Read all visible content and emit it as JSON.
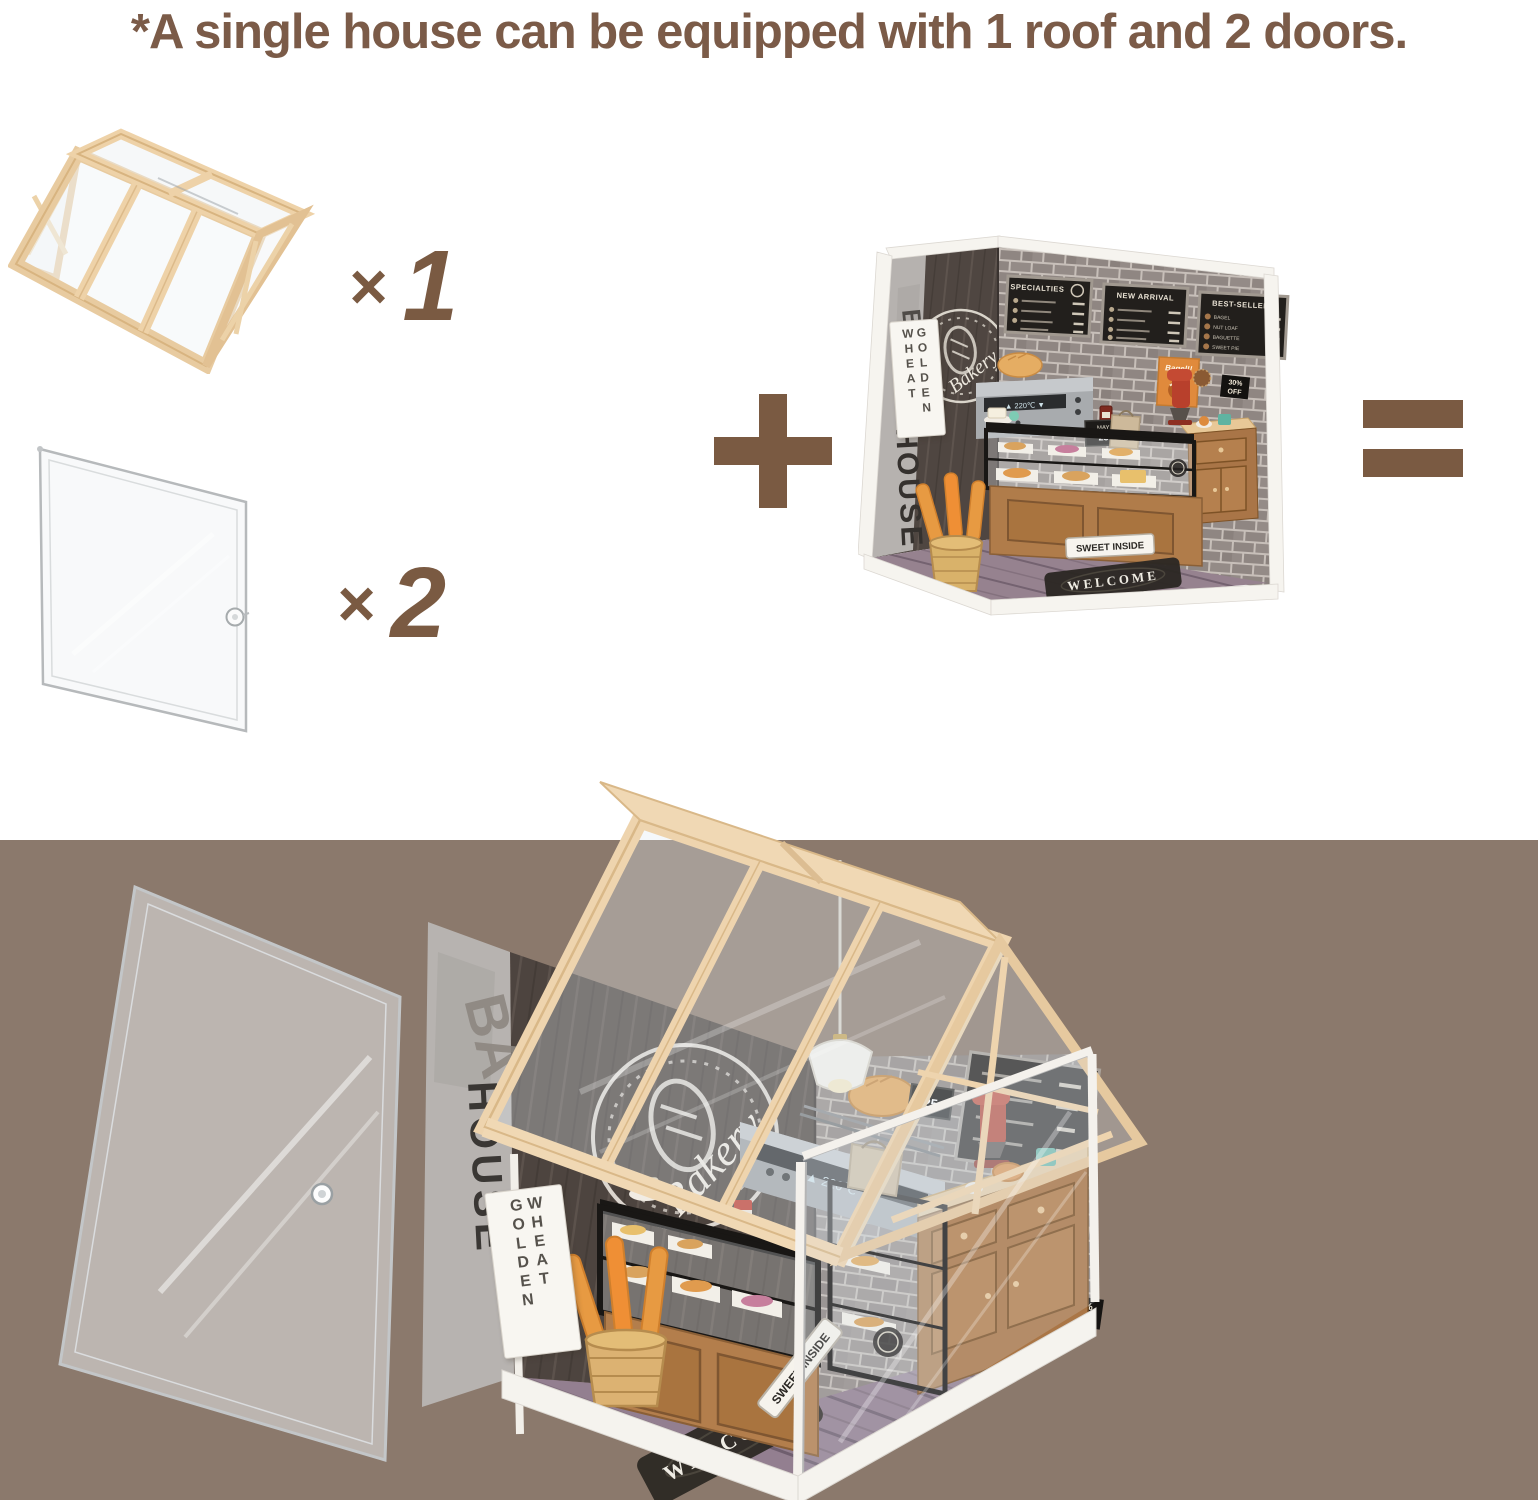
{
  "page": {
    "background": "#ffffff",
    "band_color": "#8b796c",
    "accent_text_color": "#7b5b48",
    "count_color": "#7a5a42",
    "roof_wood_color": "#eed2a8",
    "counter_wood_color": "#b07c4a"
  },
  "headline": {
    "text": "*A single house can be equipped with 1 roof and 2 doors."
  },
  "equation": {
    "times_symbol": "×",
    "roof_count": "1",
    "door_count": "2",
    "plus_symbol": "+",
    "equals_symbol": "="
  },
  "diorama": {
    "sign_wheat_golden": {
      "col1": "WHEAT",
      "col2": "GOLDEN"
    },
    "wall_letter": "B",
    "wall_word": "HOUSE",
    "logo_text": "Bakery",
    "menu_boards": [
      {
        "title": "SPECIALTIES",
        "items": []
      },
      {
        "title": "NEW ARRIVAL",
        "items": []
      },
      {
        "title": "BEST-SELLERS",
        "items": [
          "BAGEL",
          "NUT LOAF",
          "BAGUETTE",
          "SWEET PIE"
        ]
      }
    ],
    "bagel_poster": "Bagel!!",
    "discount_tag": {
      "line1": "30%",
      "line2": "OFF"
    },
    "calendar": {
      "month": "MAY",
      "day": "25"
    },
    "oven_display": "▲ 220℃ ▼",
    "sweet_inside_sign": "SWEET INSIDE",
    "welcome_mat": "WELCOME"
  },
  "assembled": {
    "sign_golden_wheat": {
      "col1": "GOLDEN",
      "col2": "WHEAT"
    },
    "wall_letters": "BA",
    "wall_word": "HOUSE",
    "logo_text": "Bakery",
    "oven_display": "▲ 220℃ ▼",
    "bagel_poster": "Bagel!!",
    "discount_tag": {
      "line1": "30%",
      "line2": "OFF"
    },
    "calendar_day": "25",
    "sweet_inside_sign": "SWEET INSIDE",
    "welcome_mat": "WELCOME"
  }
}
